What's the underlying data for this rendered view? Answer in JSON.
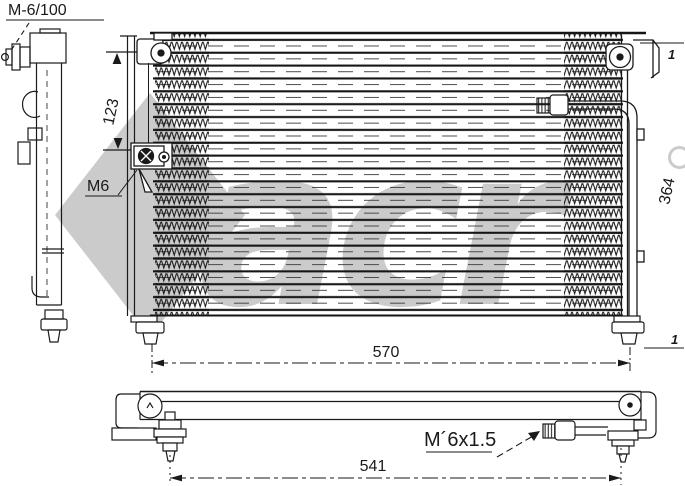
{
  "drawing_title": "AC condenser technical drawing",
  "labels": {
    "port_spec_top_left": "M-6/100",
    "dim_port_offset": "123",
    "bolt_spec": "M6",
    "dim_core_height": "364",
    "dim_core_width": "570",
    "dim_mount_span": "541",
    "thread_spec": "M´6x1.5",
    "callout_top_right": "1",
    "callout_bottom_right": "1"
  },
  "watermark": {
    "text": "acr",
    "color": "#cbcbcb"
  },
  "colors": {
    "line": "#1a1a1a",
    "background": "#ffffff"
  }
}
